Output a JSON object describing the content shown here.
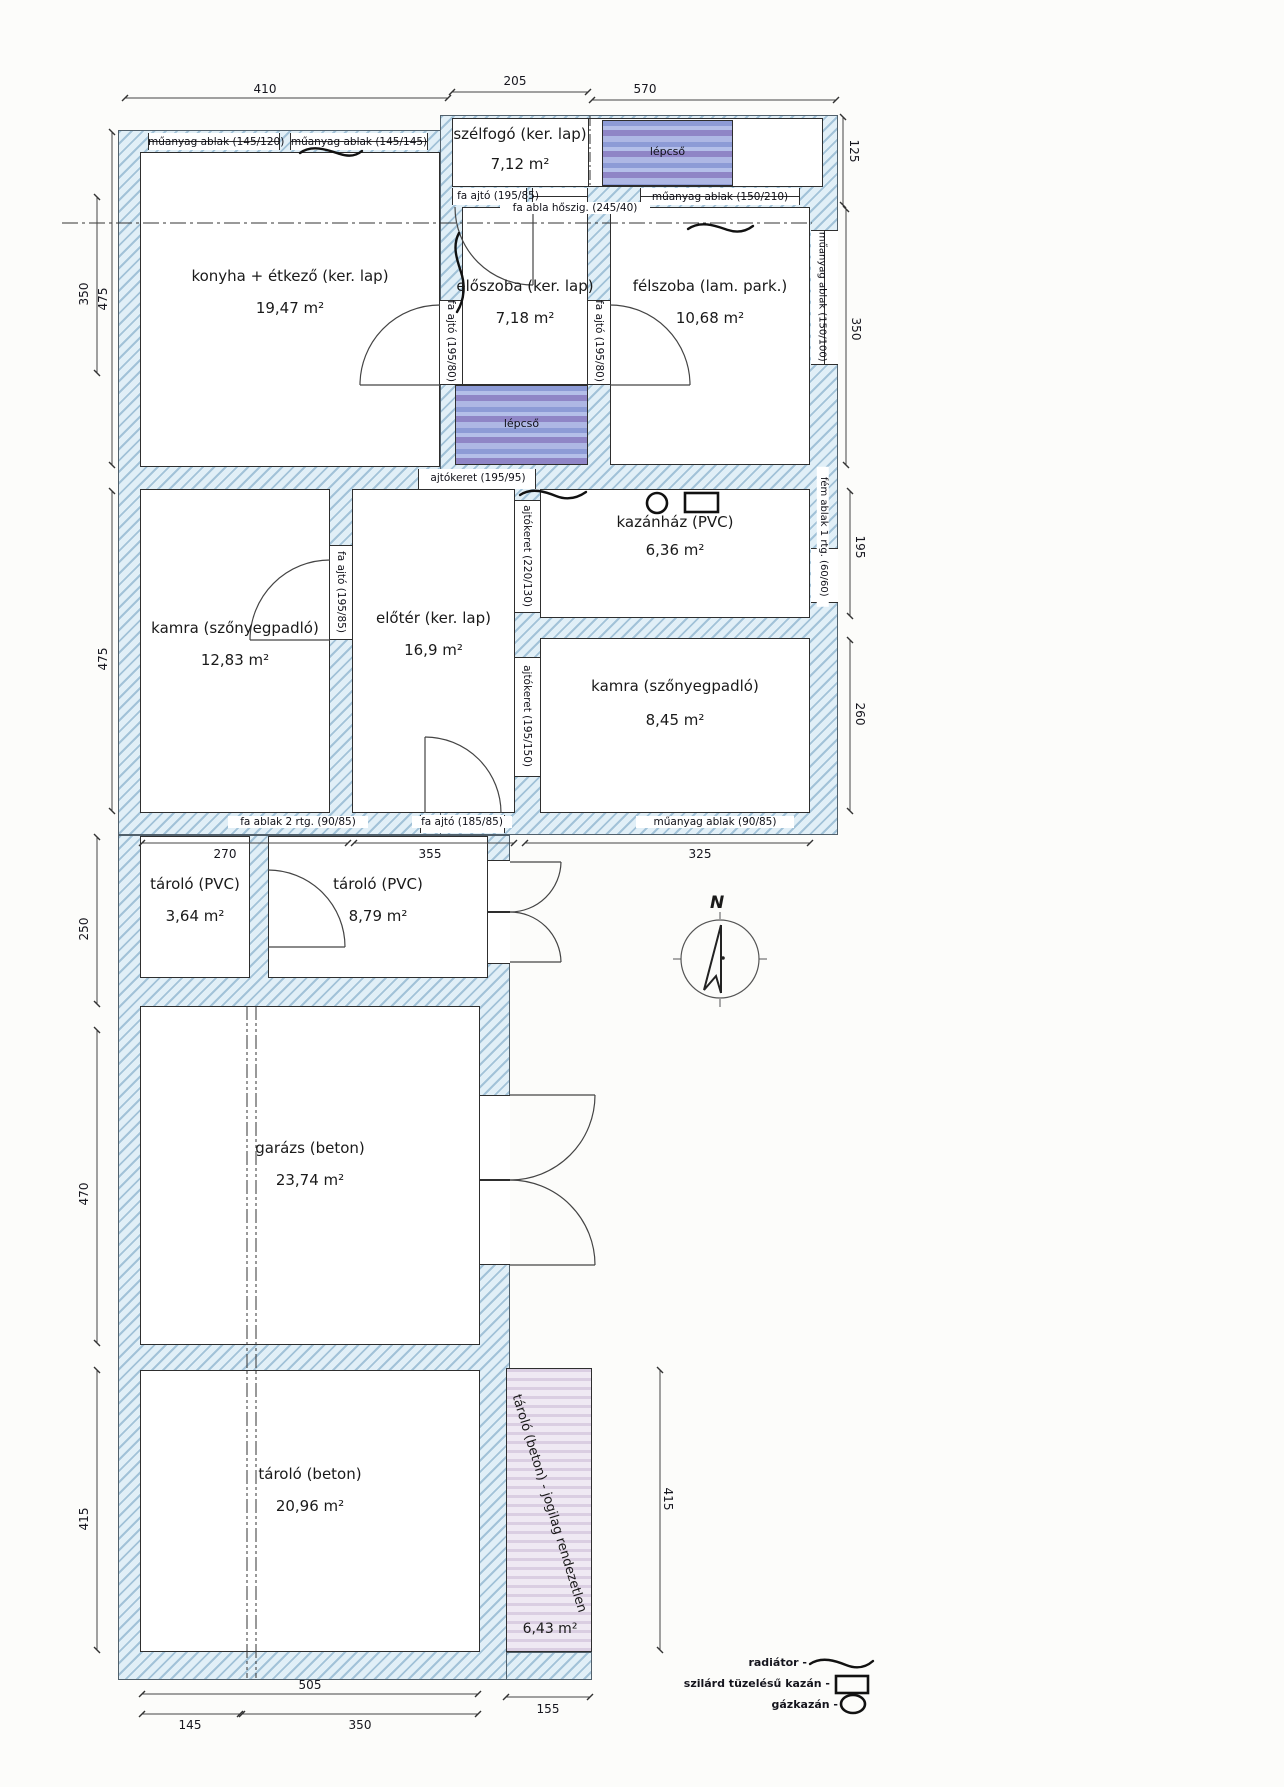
{
  "drawing": {
    "rooms": [
      {
        "name": "szélfogó (ker. lap)",
        "area": "7,12 m²"
      },
      {
        "name": "konyha + étkező (ker. lap)",
        "area": "19,47 m²"
      },
      {
        "name": "előszoba (ker. lap)",
        "area": "7,18 m²"
      },
      {
        "name": "félszoba (lam. park.)",
        "area": "10,68 m²"
      },
      {
        "name": "kamra (szőnyegpadló)",
        "area": "12,83 m²"
      },
      {
        "name": "előtér (ker. lap)",
        "area": "16,9 m²"
      },
      {
        "name": "kazánház (PVC)",
        "area": "6,36 m²"
      },
      {
        "name": "kamra (szőnyegpadló)",
        "area": "8,45 m²"
      },
      {
        "name": "tároló (PVC)",
        "area": "3,64 m²"
      },
      {
        "name": "tároló (PVC)",
        "area": "8,79 m²"
      },
      {
        "name": "garázs (beton)",
        "area": "23,74 m²"
      },
      {
        "name": "tároló (beton)",
        "area": "20,96 m²"
      },
      {
        "name": "tároló (beton) - jogilag rendezetlen",
        "area": "6,43 m²"
      }
    ],
    "stairs": {
      "label": "lépcső"
    },
    "openings": {
      "top_window_1": "műanyag ablak (145/120)",
      "top_window_2": "műanyag ablak (145/145)",
      "szelfogo_door": "fa ajtó (195/85)",
      "szelfogo_window": "fa abla hőszig. (245/40)",
      "lepcso_window": "műanyag ablak (150/210)",
      "felszoba_window_right": "műanyag ablak (150/100)",
      "eloszoba_door_left": "fa ajtó (195/80)",
      "eloszoba_door_right": "fa ajtó (195/80)",
      "mid_doorframe": "ajtókeret (195/95)",
      "kamra_door": "fa ajtó (195/85)",
      "eloter_doorframe_upper": "ajtókeret (220/130)",
      "eloter_doorframe_lower": "ajtókeret (195/150)",
      "kazanhaz_window": "fém ablak 1 rtg. (60/60)",
      "bottom_window_left": "fa ablak 2 rtg. (90/85)",
      "bottom_door": "fa ajtó (185/85)",
      "bottom_window_right": "műanyag ablak (90/85)"
    },
    "dims": {
      "t1": "410",
      "t2": "205",
      "t3": "570",
      "r1": "125",
      "r2": "350",
      "r3": "195",
      "r4": "260",
      "r5": "415",
      "l1": "350",
      "l2": "475",
      "l3": "475",
      "l4": "250",
      "l5": "470",
      "l6": "415",
      "m1": "270",
      "m2": "355",
      "m3": "325",
      "b1": "505",
      "b2": "145",
      "b3": "350",
      "b4": "155"
    },
    "legend": {
      "radiator": "radiátor -",
      "solid_fuel_boiler": "szilárd tüzelésű kazán -",
      "gas_boiler": "gázkazán -"
    },
    "compass": {
      "north": "N"
    },
    "colors": {
      "wall_hatch": "#e1eff7",
      "stairs_blue": "#8d9bd6",
      "legal_issue_pink": "#efe9f3"
    }
  }
}
